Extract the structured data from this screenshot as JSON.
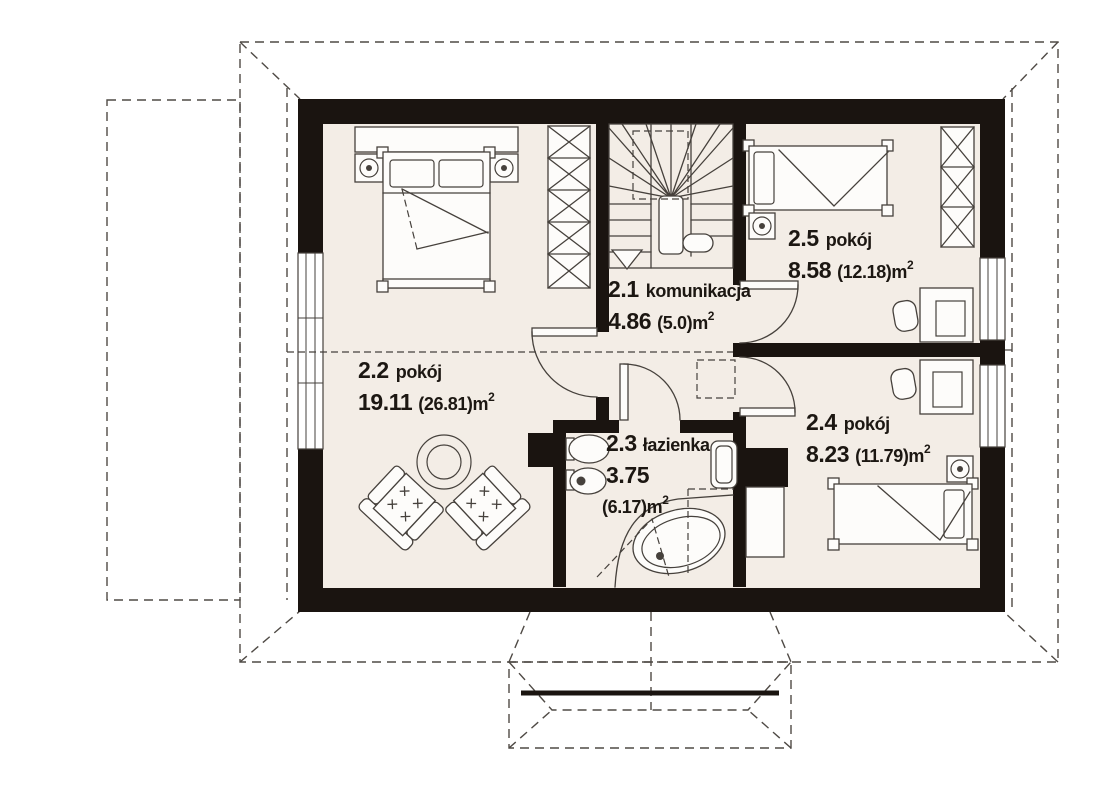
{
  "rooms": {
    "r21": {
      "number": "2.1",
      "name": "komunikacja",
      "area_net": "4.86",
      "area_gross": "(5.0)",
      "unit": "m",
      "unit_sup": "2"
    },
    "r22": {
      "number": "2.2",
      "name": "pokój",
      "area_net": "19.11",
      "area_gross": "(26.81)",
      "unit": "m",
      "unit_sup": "2"
    },
    "r23": {
      "number": "2.3",
      "name": "łazienka",
      "area_net": "3.75",
      "area_gross": "(6.17)",
      "unit": "m",
      "unit_sup": "2"
    },
    "r24": {
      "number": "2.4",
      "name": "pokój",
      "area_net": "8.23",
      "area_gross": "(11.79)",
      "unit": "m",
      "unit_sup": "2"
    },
    "r25": {
      "number": "2.5",
      "name": "pokój",
      "area_net": "8.58",
      "area_gross": "(12.18)",
      "unit": "m",
      "unit_sup": "2"
    }
  },
  "colors": {
    "background": "#ffffff",
    "wall": "#1a1410",
    "floor": "#f3ede6",
    "line": "#46413c",
    "dash": "#4f4a45",
    "text": "#1c1712"
  }
}
